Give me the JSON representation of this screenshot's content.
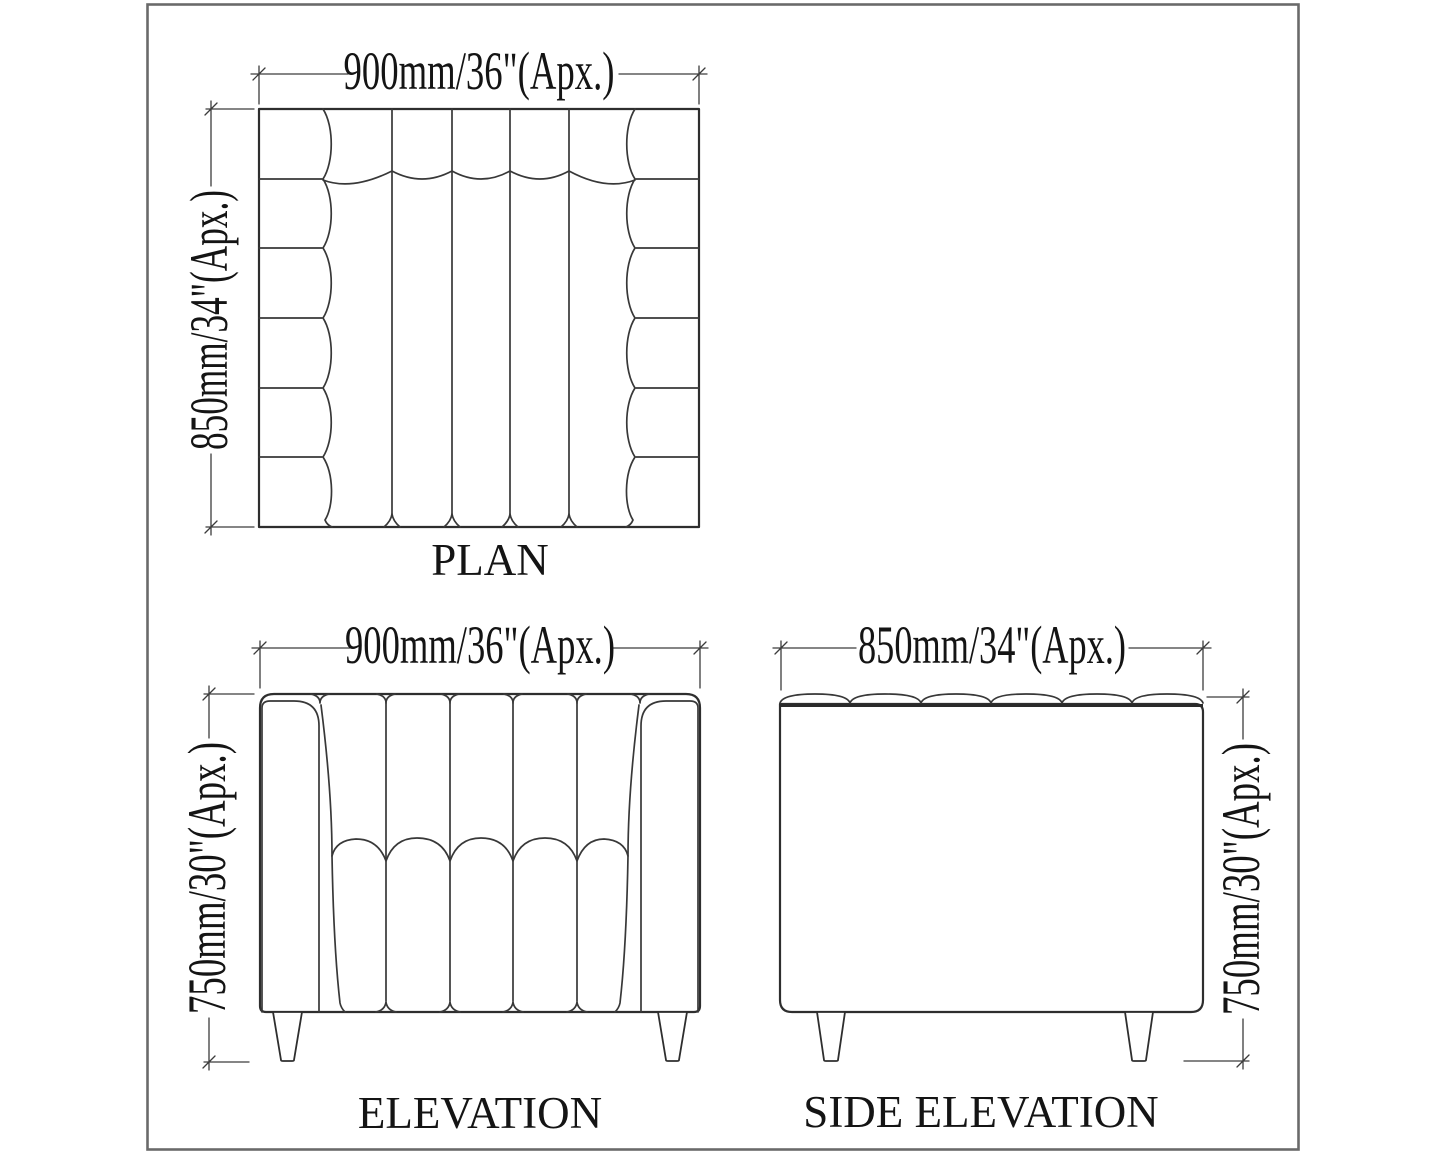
{
  "sheet": {
    "background": "#ffffff",
    "border_color": "#6a6a6a",
    "line_color": "#2e2e2e",
    "text_color": "#141414"
  },
  "views": {
    "plan": {
      "label": "PLAN",
      "top_dim": "900mm/36\"(Apx.)",
      "left_dim": "850mm/34\"(Apx.)"
    },
    "elevation": {
      "label": "ELEVATION",
      "top_dim": "900mm/36\"(Apx.)",
      "left_dim": "750mm/30\"(Apx.)"
    },
    "side_elevation": {
      "label": "SIDE ELEVATION",
      "top_dim": "850mm/34\"(Apx.)",
      "right_dim": "750mm/30\"(Apx.)"
    }
  }
}
